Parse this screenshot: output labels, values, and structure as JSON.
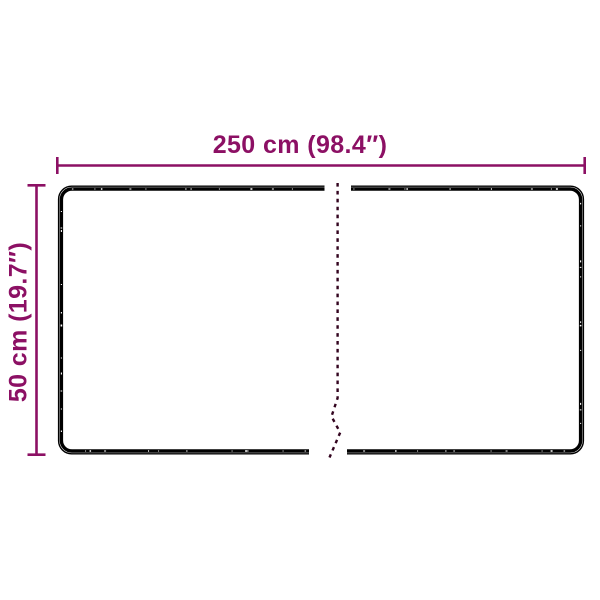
{
  "colors": {
    "accent": "#8C1064",
    "outline": "#000000",
    "break_line": "#33041F",
    "background": "#FFFFFF"
  },
  "dimensions": {
    "width": {
      "label": "250 cm (98.4″)"
    },
    "height": {
      "label": "50 cm (19.7″)"
    }
  }
}
